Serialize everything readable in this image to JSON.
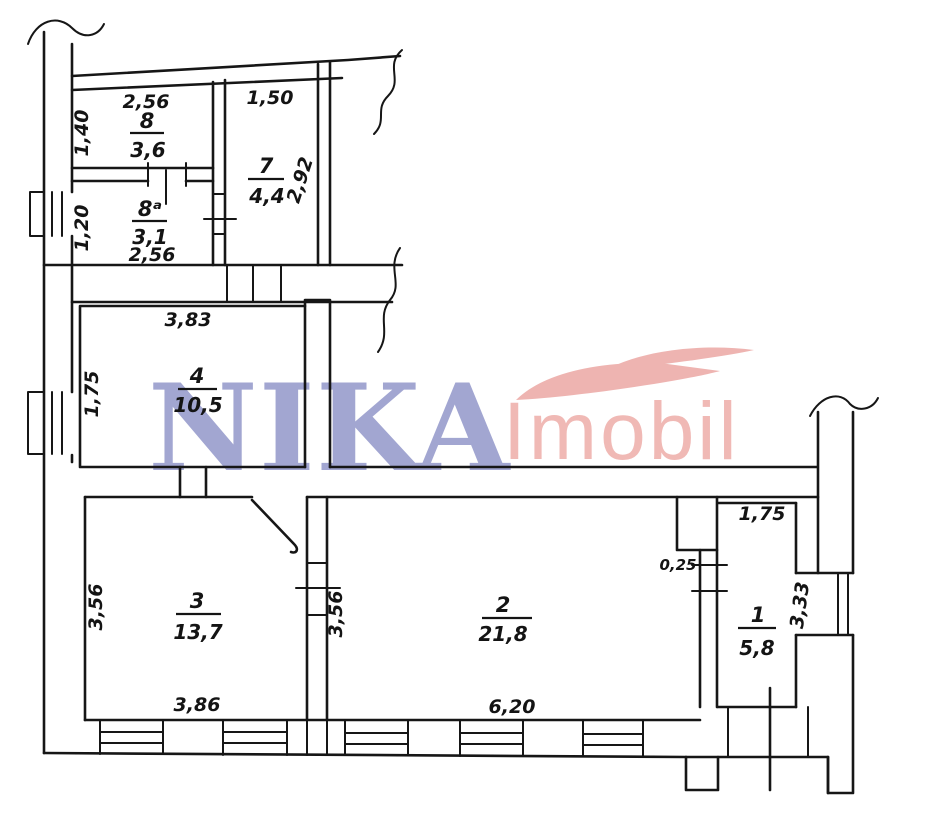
{
  "watermark": {
    "brand": "NIKA",
    "brand_suffix": "Imobil",
    "brand_color": "#8e93c8",
    "suffix_color": "#edaaa6",
    "swoosh_color": "#eba4a0"
  },
  "plan": {
    "wall_color": "#161616",
    "background": "#ffffff"
  },
  "rooms": [
    {
      "number": "8",
      "area": "3,6",
      "dims": {
        "top": "2,56",
        "left": "1,40"
      }
    },
    {
      "number": "8ᵃ",
      "area": "3,1",
      "dims": {
        "left": "1,20",
        "bottom": "2,56"
      }
    },
    {
      "number": "7",
      "area": "4,4",
      "dims": {
        "top": "1,50",
        "right": "2,92"
      }
    },
    {
      "number": "4",
      "area": "10,5",
      "dims": {
        "top": "3,83",
        "left": "1,75"
      }
    },
    {
      "number": "3",
      "area": "13,7",
      "dims": {
        "left": "3,56",
        "bottom": "3,86"
      }
    },
    {
      "number": "2",
      "area": "21,8",
      "dims": {
        "left": "3,56",
        "bottom": "6,20",
        "niche": "0,25"
      }
    },
    {
      "number": "1",
      "area": "5,8",
      "dims": {
        "top": "1,75",
        "right": "3,33"
      }
    }
  ]
}
